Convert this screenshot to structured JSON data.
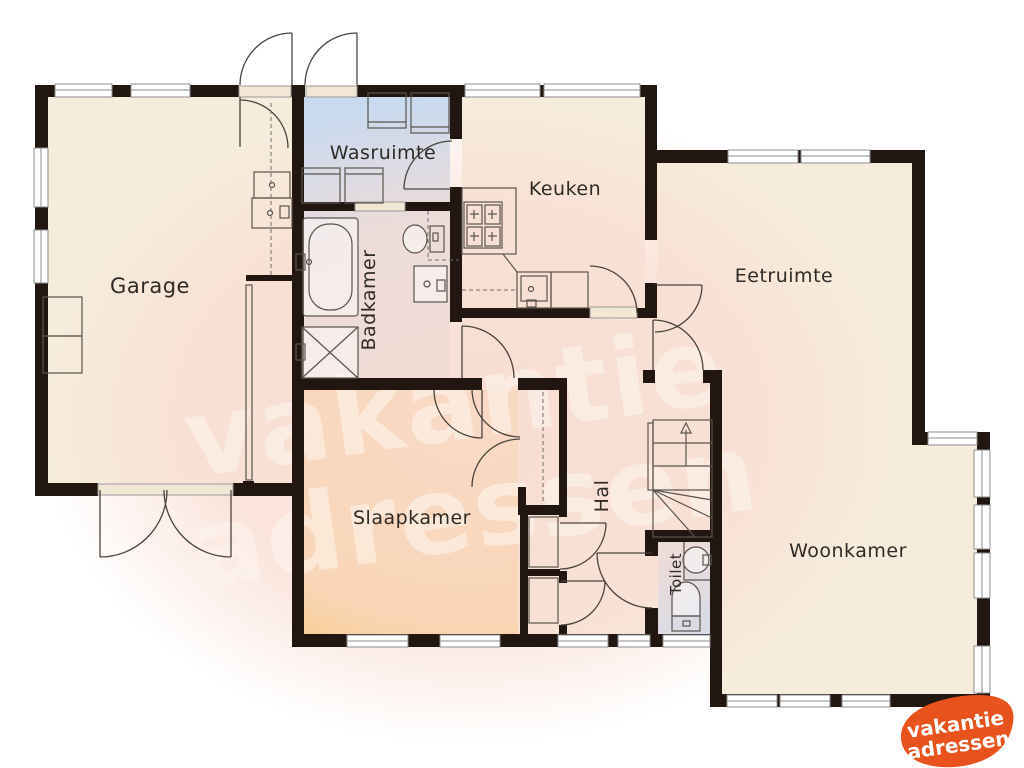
{
  "watermark": {
    "line1": "vakantie",
    "line2": "adressen"
  },
  "logo": {
    "line1": "vakantie",
    "line2": "adressen",
    "background_color": "#e8521c",
    "text_color": "#ffffff"
  },
  "colors": {
    "wall": "#221710",
    "room_beige": "#f6ecdc",
    "room_blue": "#c8daf0",
    "room_orange": "#f8c469",
    "watermark_blob": "#f9ddd2",
    "background": "#ffffff"
  },
  "rooms": [
    {
      "id": "garage",
      "label": "Garage"
    },
    {
      "id": "wasruimte",
      "label": "Wasruimte"
    },
    {
      "id": "keuken",
      "label": "Keuken"
    },
    {
      "id": "eetruimte",
      "label": "Eetruimte"
    },
    {
      "id": "badkamer",
      "label": "Badkamer"
    },
    {
      "id": "slaapkamer",
      "label": "Slaapkamer"
    },
    {
      "id": "hal",
      "label": "Hal"
    },
    {
      "id": "toilet",
      "label": "Toilet"
    },
    {
      "id": "woonkamer",
      "label": "Woonkamer"
    }
  ]
}
